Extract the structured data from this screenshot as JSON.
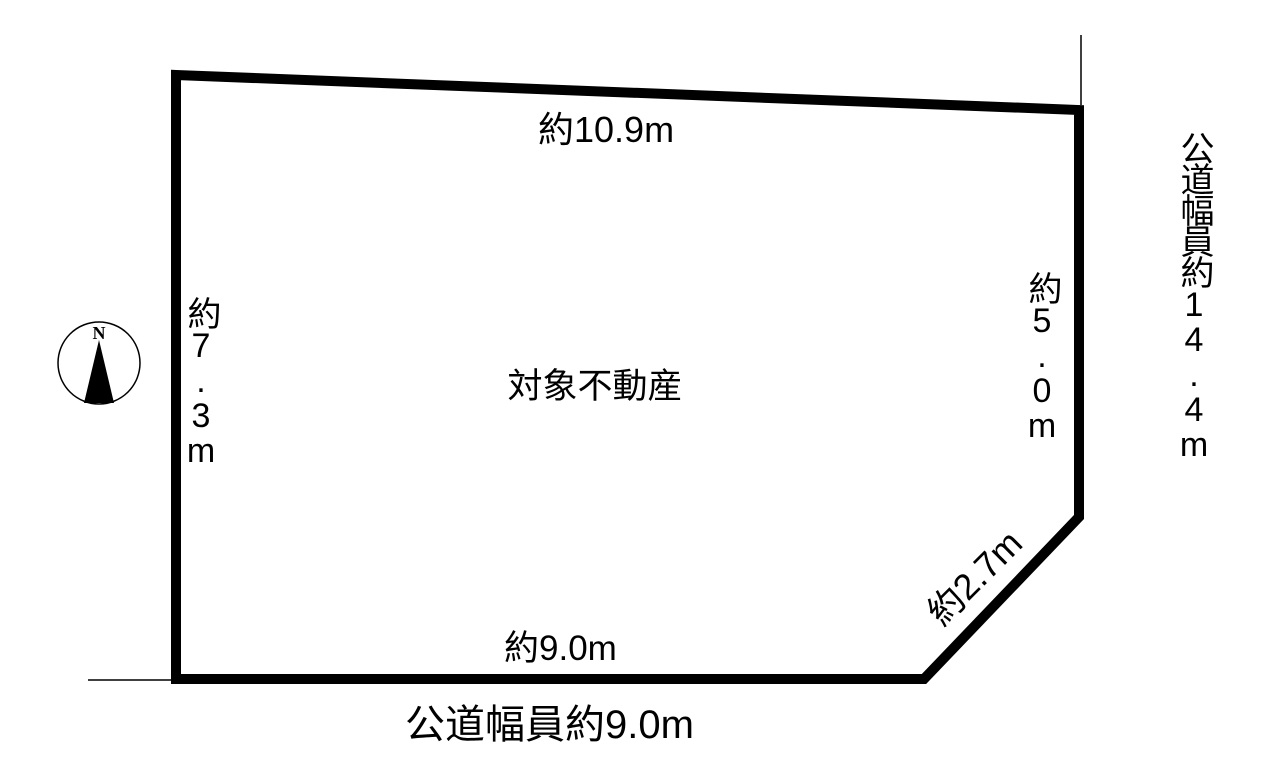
{
  "diagram": {
    "subject_label": "対象不動産",
    "compass": {
      "north_label": "N"
    },
    "dimensions": {
      "top": "約10.9m",
      "left": "約7.3m",
      "right": "約5.0m",
      "corner_cut": "約2.7m",
      "bottom": "約9.0m"
    },
    "roads": {
      "bottom_width": "公道幅員約9.0m",
      "right_width": "公道幅員約14.4m"
    },
    "colors": {
      "line": "#000000",
      "background": "#ffffff",
      "text": "#000000"
    }
  }
}
